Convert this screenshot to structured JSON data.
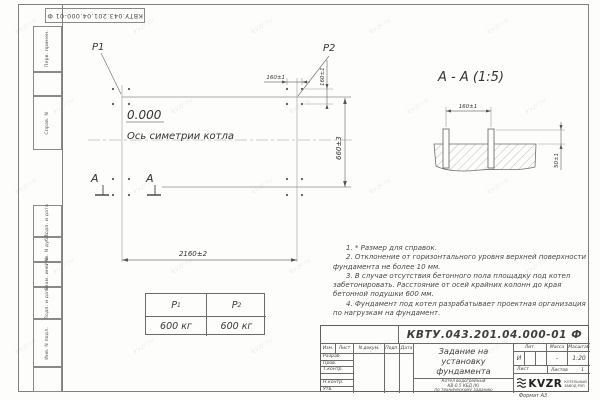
{
  "designation": "КВТУ.043.201.04.000-01 Ф",
  "sheet": {
    "watermark": "kvzr.ru",
    "format_label": "Формат А3"
  },
  "frame_stamps": {
    "top": [
      "Перв. примен.",
      "Справ. N"
    ],
    "bottom": [
      "Подп. и дата",
      "Инв. N дубл.",
      "Взам. инв. N",
      "Подп. и дата",
      "Инв. N подл."
    ]
  },
  "plan": {
    "p1": "P1",
    "p2": "P2",
    "elevation": "0.000",
    "axis_label": "Ось симетрии котла",
    "section_letter": "А",
    "dim_width": "2160±2",
    "dim_height": "660±3",
    "dim_bolt_x": "160±1",
    "dim_bolt_y": "160±1"
  },
  "section": {
    "title": "А - А (1:5)",
    "dim_spacing": "160±1",
    "dim_height": "50±1"
  },
  "loads": {
    "p1_label": "P",
    "p1_sub": "1",
    "p1_value": "600 кг",
    "p2_label": "P",
    "p2_sub": "2",
    "p2_value": "600 кг"
  },
  "notes": [
    "1. * Размер для справок.",
    "2. Отклонение от горизонтального уровня верхней поверхности фундамента не более 10 мм.",
    "3. В случае отсутствия бетонного пола площадку под котел забетонировать. Расстояние от осей крайних колонн до края бетонной подушки 600 мм.",
    "4. Фундамент под котел разрабатывает проектная организация по нагрузкам на фундамент."
  ],
  "title_block": {
    "doc_title_line1": "Задание на",
    "doc_title_line2": "установку",
    "doc_title_line3": "фундамента",
    "product_line1": "Котел водогрейный",
    "product_line2": "КВ-0.5 КБД (К)",
    "product_line3": "по техническому заданию",
    "header_cells": [
      "Изм.",
      "Лист",
      "N докум.",
      "Подп.",
      "Дата"
    ],
    "row_labels": [
      "Разраб.",
      "Пров.",
      "Т.контр.",
      "",
      "Н.контр.",
      "Утв."
    ],
    "lit_label": "Лит.",
    "lit_value": "И",
    "mass_label": "Масса",
    "mass_value": "-",
    "scale_label": "Масштаб",
    "scale_value": "1:20",
    "sheet_label": "Лист",
    "sheets_label": "Листов",
    "sheets_value": "1",
    "logo_text": "KVZR",
    "logo_caption_line1": "КОТЕЛЬНЫЙ",
    "logo_caption_line2": "ЗАВОД РЭП"
  }
}
